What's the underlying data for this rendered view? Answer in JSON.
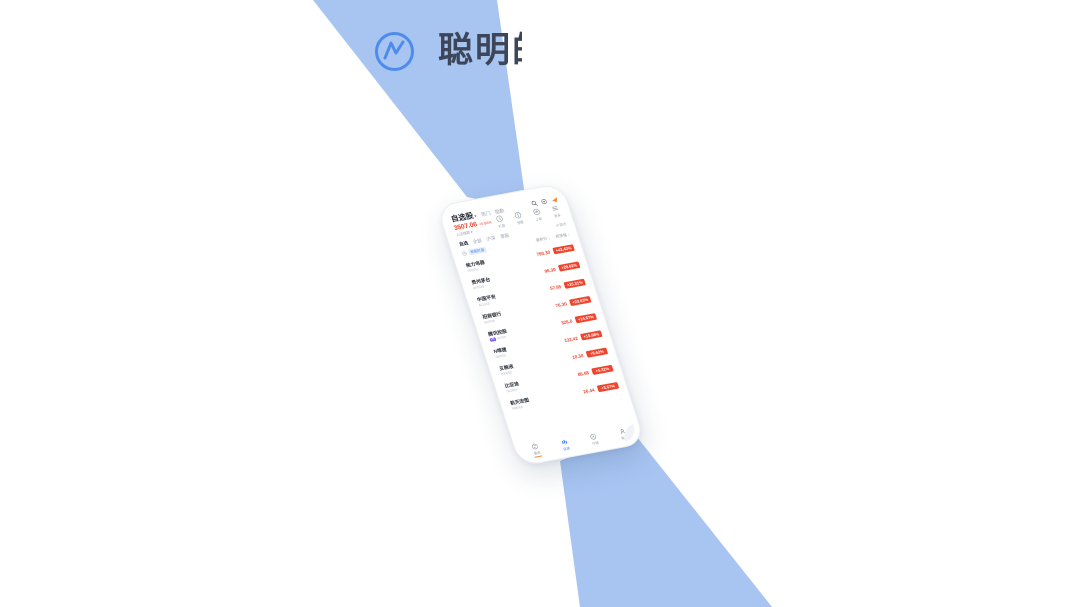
{
  "colors": {
    "accent_blue": "#4E8BEA",
    "band_blue": "#A8C5F2",
    "up_red": "#F0442E",
    "text_dark": "#3C4658",
    "promo_orange": "#F5862B",
    "tag_purple": "#7C5CE8",
    "active_blue": "#3B7CFF"
  },
  "logo": {
    "brand_text": "聪明的"
  },
  "phone": {
    "header": {
      "title": "自选股",
      "caret": "▾",
      "tabs": [
        "热门",
        "指数"
      ]
    },
    "features": [
      {
        "icon": "watch-icon",
        "label": "盯盘"
      },
      {
        "icon": "alert-icon",
        "label": "预警"
      },
      {
        "icon": "new-icon",
        "label": "上新"
      },
      {
        "icon": "more-icon",
        "label": "更多"
      }
    ],
    "index": {
      "value": "3507.06",
      "change": "+0.84%",
      "name": "上证指数 ▾"
    },
    "filters": {
      "tabs": [
        "自选",
        "全部",
        "沪深",
        "港股"
      ],
      "right": "IP属地"
    },
    "notice": {
      "tag": "智能盯盘",
      "ellipsis": "···"
    },
    "list_header": {
      "price_label": "最新价 ↓",
      "change_label": "按涨幅 ↓"
    },
    "stocks": [
      {
        "name": "格力电器",
        "code": "000651",
        "price": "790.30",
        "change": "+42.43%"
      },
      {
        "name": "贵州茅台",
        "code": "600519",
        "price": "96.30",
        "change": "+29.62%"
      },
      {
        "name": "中国平安",
        "code": "601318",
        "price": "57.65",
        "change": "+25.31%"
      },
      {
        "name": "招商银行",
        "code": "600036",
        "price": "76.30",
        "change": "+22.63%"
      },
      {
        "name": "腾讯控股",
        "code": "00700",
        "tag": "HK",
        "price": "326.6",
        "change": "+14.67%"
      },
      {
        "name": "N唯捷",
        "code": "688153",
        "price": "132.42",
        "change": "+10.68%"
      },
      {
        "name": "五粮液",
        "code": "000858",
        "price": "10.30",
        "change": "+8.62%"
      },
      {
        "name": "比亚迪",
        "code": "002594",
        "price": "86.68",
        "change": "+5.31%"
      },
      {
        "name": "航天宏图",
        "code": "688066",
        "price": "26.44",
        "change": "+3.57%"
      }
    ],
    "tabbar": {
      "items": [
        {
          "label": "要闻",
          "active": false
        },
        {
          "label": "自选",
          "active": true
        },
        {
          "label": "行情",
          "active": false
        },
        {
          "label": "我的",
          "active": false
        }
      ]
    }
  }
}
